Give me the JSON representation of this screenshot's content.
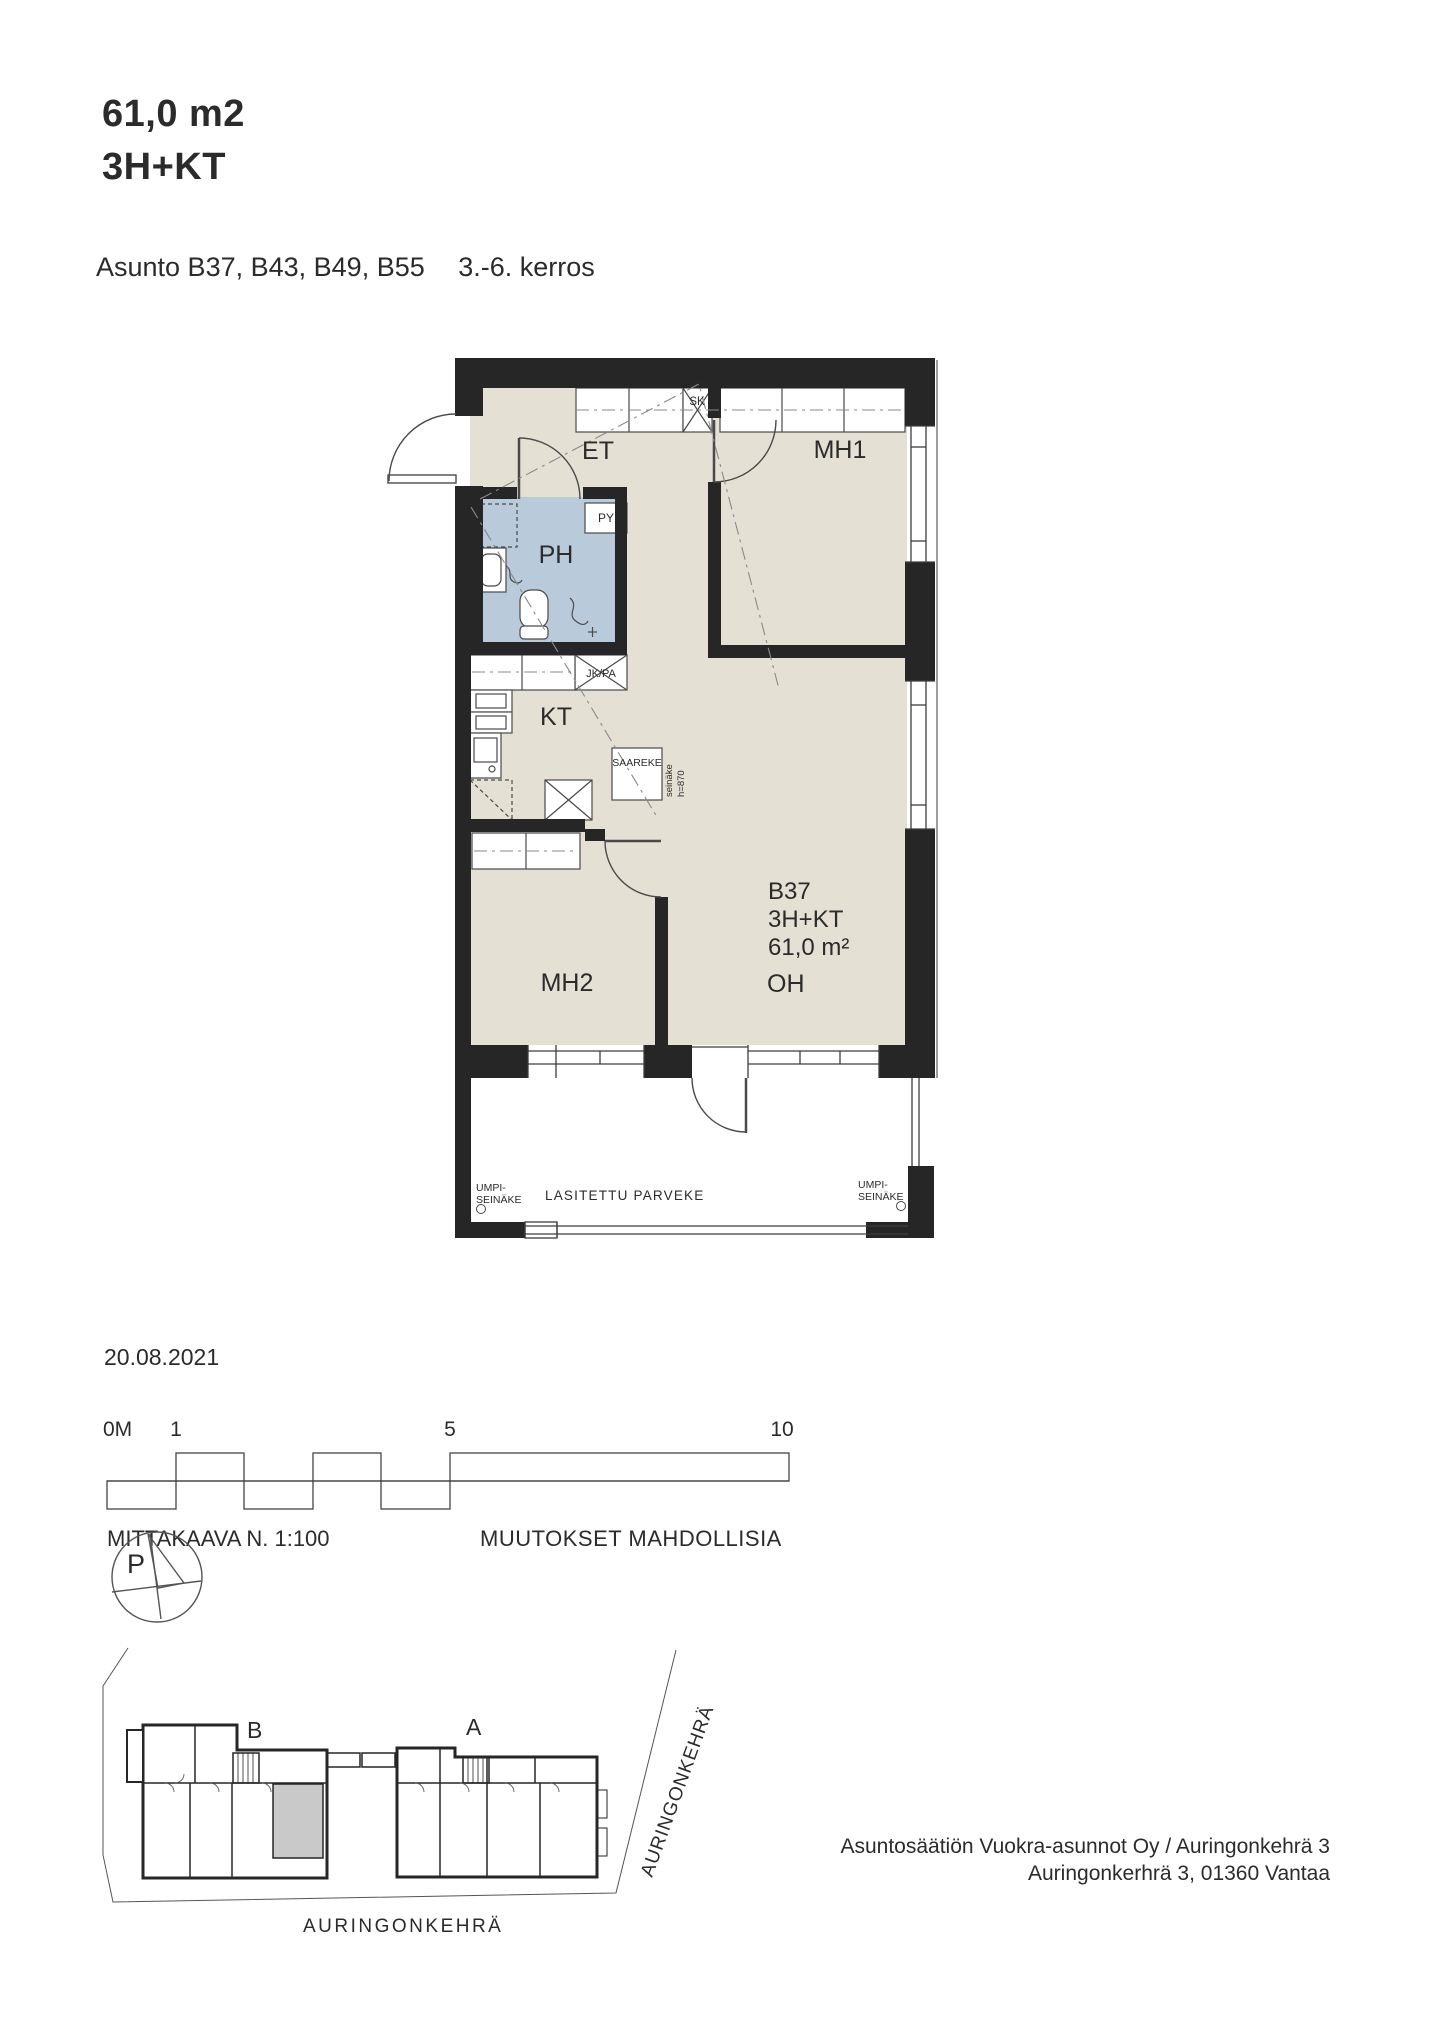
{
  "header": {
    "area": "61,0 m2",
    "type": "3H+KT",
    "apartments": "Asunto B37, B43, B49, B55",
    "floors": "3.-6. kerros"
  },
  "plan": {
    "rooms": {
      "et": "ET",
      "mh1": "MH1",
      "ph": "PH",
      "kt": "KT",
      "mh2": "MH2",
      "oh": "OH"
    },
    "unit": {
      "id": "B37",
      "type": "3H+KT",
      "area": "61,0 m²"
    },
    "labels": {
      "sk": "SK",
      "py": "PY",
      "jkpa": "JK/PA",
      "saareke": "SAAREKE",
      "seinake_line1": "seinäke",
      "seinake_line2": "h=870",
      "umpi_line1": "UMPI-",
      "umpi_line2": "SEINÄKE",
      "balcony": "LASITETTU PARVEKE"
    }
  },
  "scale": {
    "date": "20.08.2021",
    "tick0": "0M",
    "tick1": "1",
    "tick5": "5",
    "tick10": "10",
    "ratio": "MITTAKAAVA N. 1:100",
    "note": "MUUTOKSET MAHDOLLISIA"
  },
  "site": {
    "north": "P",
    "building_left": "B",
    "building_right": "A",
    "street": "AURINGONKEHRÄ",
    "street_side": "AURINGONKEHRÄ"
  },
  "footer": {
    "line1": "Asuntosäätiön Vuokra-asunnot Oy / Auringonkehrä 3",
    "line2": "Auringonkerhrä 3, 01360 Vantaa"
  },
  "colors": {
    "wall": "#262626",
    "floor": "#e4e0d3",
    "bathroom": "#b9cada",
    "highlight_unit": "#c9c9c9"
  }
}
